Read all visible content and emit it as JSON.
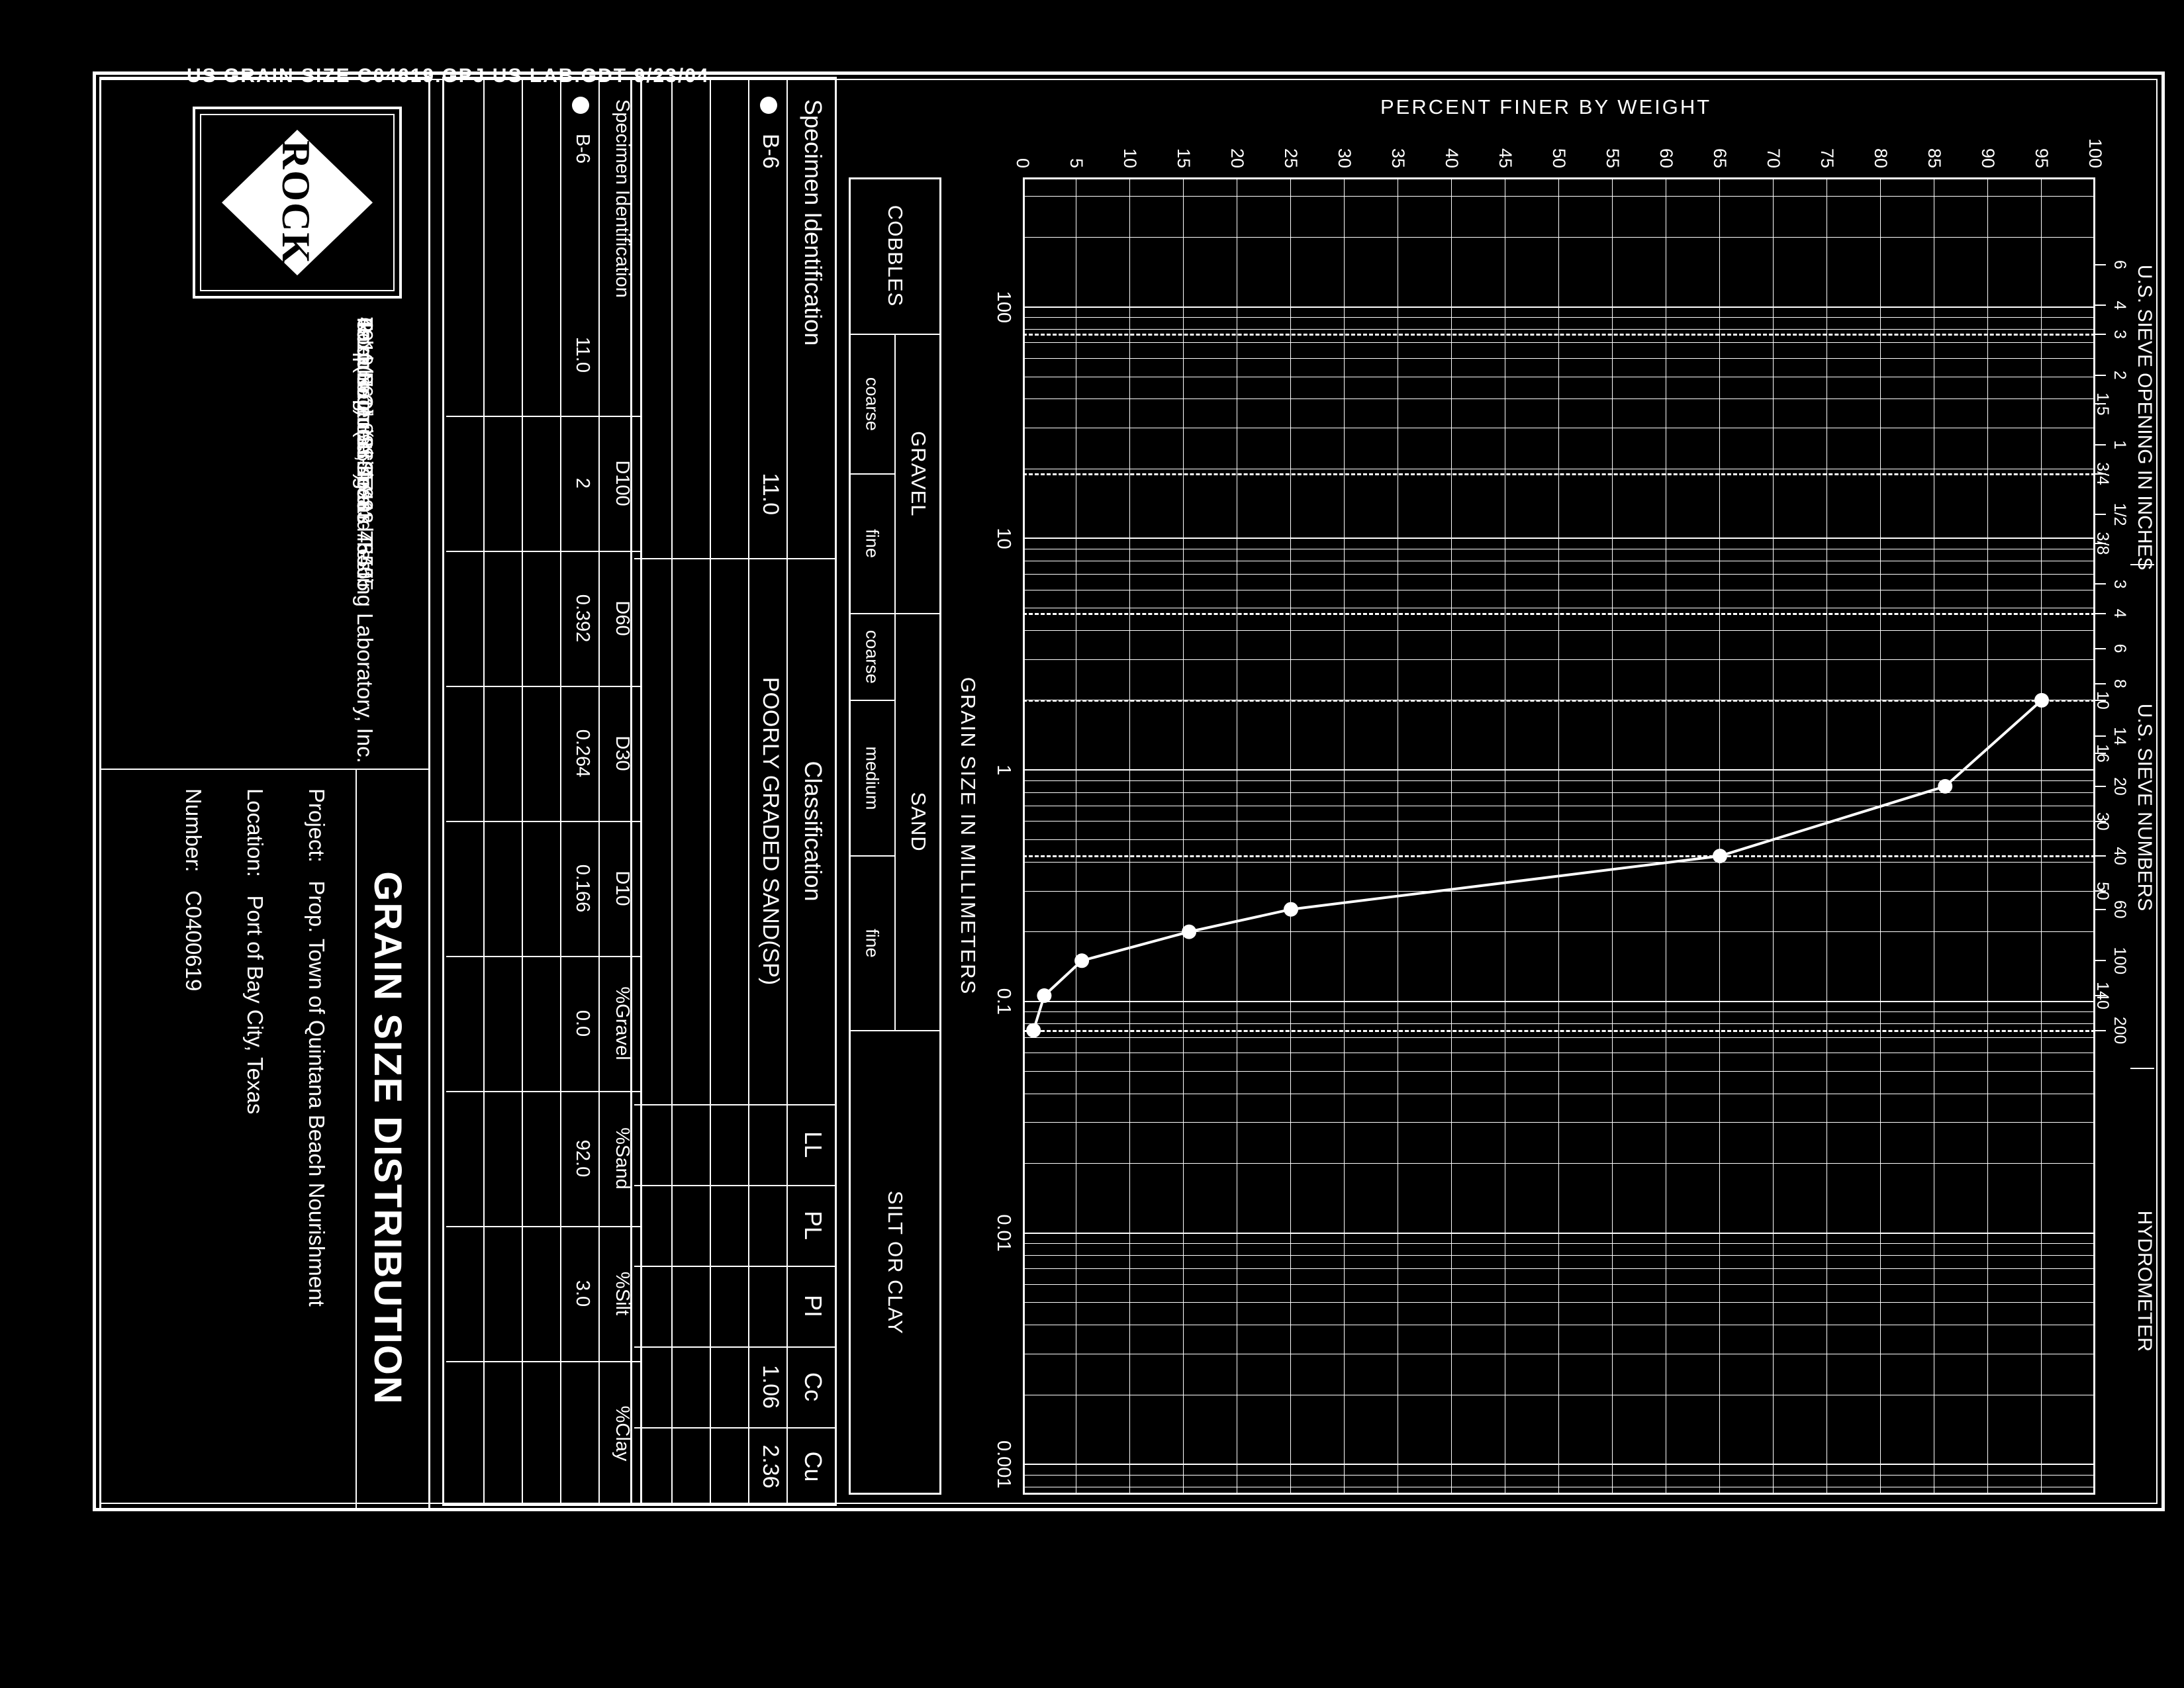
{
  "colors": {
    "paper": "#000000",
    "ink": "#ffffff"
  },
  "file_note": "US GRAIN SIZE C04619.GPJ US LAB.GDT 9/23/04",
  "chart_data": {
    "type": "line",
    "y_axis_title": "PERCENT FINER BY WEIGHT",
    "x_axis_title": "GRAIN SIZE IN MILLIMETERS",
    "x_scale": "log",
    "x_range_mm": [
      363,
      0.00074
    ],
    "ylim": [
      0,
      100
    ],
    "y_tick_step": 5,
    "x_decade_labels": [
      "100",
      "10",
      "1",
      "0.1",
      "0.01",
      "0.001"
    ],
    "grid": "on",
    "top_axis_sections": [
      {
        "label": "U.S. SIEVE OPENING IN INCHES",
        "ticks": [
          {
            "t": "6",
            "mm": 152.4,
            "row": "hi"
          },
          {
            "t": "4",
            "mm": 101.6,
            "row": "hi"
          },
          {
            "t": "3",
            "mm": 76.2,
            "row": "hi"
          },
          {
            "t": "2",
            "mm": 50.8,
            "row": "hi"
          },
          {
            "t": "1.5",
            "mm": 38.1,
            "row": "lo"
          },
          {
            "t": "1",
            "mm": 25.4,
            "row": "hi"
          },
          {
            "t": "3/4",
            "mm": 19.05,
            "row": "lo"
          },
          {
            "t": "1/2",
            "mm": 12.7,
            "row": "hi"
          },
          {
            "t": "3/8",
            "mm": 9.525,
            "row": "lo"
          }
        ]
      },
      {
        "label": "U.S. SIEVE NUMBERS",
        "ticks": [
          {
            "t": "3",
            "mm": 6.35,
            "row": "hi"
          },
          {
            "t": "4",
            "mm": 4.75,
            "row": "hi"
          },
          {
            "t": "6",
            "mm": 3.35,
            "row": "hi"
          },
          {
            "t": "8",
            "mm": 2.36,
            "row": "hi"
          },
          {
            "t": "10",
            "mm": 2.0,
            "row": "lo"
          },
          {
            "t": "14",
            "mm": 1.4,
            "row": "hi"
          },
          {
            "t": "16",
            "mm": 1.18,
            "row": "lo"
          },
          {
            "t": "20",
            "mm": 0.85,
            "row": "hi"
          },
          {
            "t": "30",
            "mm": 0.6,
            "row": "lo"
          },
          {
            "t": "40",
            "mm": 0.425,
            "row": "hi"
          },
          {
            "t": "50",
            "mm": 0.3,
            "row": "lo"
          },
          {
            "t": "60",
            "mm": 0.25,
            "row": "hi"
          },
          {
            "t": "100",
            "mm": 0.15,
            "row": "hi"
          },
          {
            "t": "140",
            "mm": 0.106,
            "row": "lo"
          },
          {
            "t": "200",
            "mm": 0.075,
            "row": "hi"
          }
        ]
      },
      {
        "label": "HYDROMETER",
        "ticks": []
      }
    ],
    "dashed_boundaries_mm": [
      76.2,
      19.05,
      4.75,
      2.0,
      0.425,
      0.075
    ],
    "series": [
      {
        "name": "B-6",
        "depth": "11.0",
        "symbol": "filled-circle",
        "points_mm_pct": [
          [
            2.0,
            95
          ],
          [
            0.85,
            86
          ],
          [
            0.425,
            65
          ],
          [
            0.25,
            25
          ],
          [
            0.2,
            15.5
          ],
          [
            0.15,
            5.5
          ],
          [
            0.106,
            2
          ],
          [
            0.075,
            1
          ]
        ]
      }
    ]
  },
  "fraction_bar": {
    "segments": [
      {
        "label": "COBBLES",
        "merged": true,
        "to_mm": 76.2
      },
      {
        "label": "GRAVEL",
        "subs": [
          {
            "label": "coarse",
            "to_mm": 19.05
          },
          {
            "label": "fine",
            "to_mm": 4.75
          }
        ]
      },
      {
        "label": "SAND",
        "subs": [
          {
            "label": "coarse",
            "to_mm": 2.0
          },
          {
            "label": "medium",
            "to_mm": 0.425
          },
          {
            "label": "fine",
            "to_mm": 0.075
          }
        ]
      },
      {
        "label": "SILT OR CLAY",
        "merged": true,
        "to_mm": null
      }
    ]
  },
  "legend_table": {
    "spec_header": "Specimen Identification",
    "headers": [
      "Classification",
      "LL",
      "PL",
      "PI",
      "Cc",
      "Cu"
    ],
    "rows": [
      {
        "symbol": "filled-circle",
        "id": "B-6",
        "depth": "11.0",
        "values": [
          "POORLY GRADED SAND(SP)",
          "",
          "",
          "",
          "1.06",
          "2.36"
        ]
      }
    ],
    "empty_row_count": 3
  },
  "gradation_table": {
    "spec_header": "Specimen Identification",
    "headers": [
      "D100",
      "D60",
      "D30",
      "D10",
      "%Gravel",
      "%Sand",
      "%Silt",
      "%Clay"
    ],
    "rows": [
      {
        "symbol": "filled-circle",
        "id": "B-6",
        "depth": "11.0",
        "values": [
          "2",
          "0.392",
          "0.264",
          "0.166",
          "0.0",
          "92.0",
          "3.0",
          ""
        ]
      }
    ],
    "empty_row_count": 3
  },
  "footer": {
    "logo_text": "ROCK",
    "company_lines": [
      "Rock Engineering and Testing Laboratory, Inc.",
      "4910 Neptune Street",
      "Corpus Christi, Texas  78405",
      "Telephone:  (361) 883-4555",
      "Fax:  (361) 883-4711"
    ],
    "report_title": "GRAIN SIZE DISTRIBUTION",
    "project_label": "Project:",
    "project_value": "Prop. Town of Quintana Beach Nourishment",
    "location_label": "Location:",
    "location_value": "Port of Bay City, Texas",
    "number_label": "Number:",
    "number_value": "C0400619"
  }
}
